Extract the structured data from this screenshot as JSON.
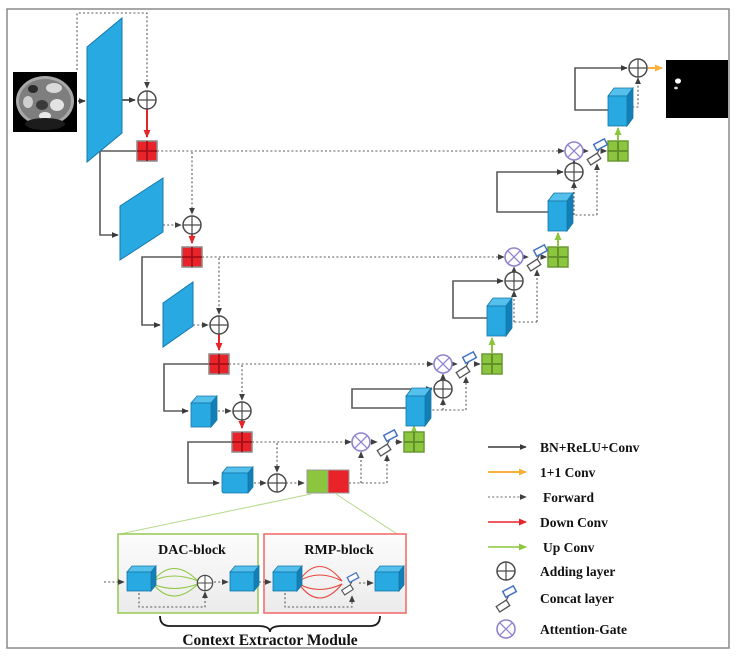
{
  "figure": {
    "labels": {
      "dac_block": "DAC-block",
      "rmp_block": "RMP-block",
      "context_extractor": "Context Extractor Module"
    }
  },
  "legend": {
    "items": [
      {
        "icon": "black-solid-arrow",
        "label": "BN+ReLU+Conv",
        "color": "#3a3a3a"
      },
      {
        "icon": "yellow-solid-arrow",
        "label": "1+1 Conv",
        "color": "#FBB03B"
      },
      {
        "icon": "gray-dotted-arrow",
        "label": "Forward",
        "color": "#666666"
      },
      {
        "icon": "red-solid-arrow",
        "label": "Down Conv",
        "color": "#E8232A"
      },
      {
        "icon": "green-solid-arrow",
        "label": "Up Conv",
        "color": "#8CC63F"
      },
      {
        "icon": "adding-layer-icon",
        "label": "Adding layer",
        "color": "#4a4a4a"
      },
      {
        "icon": "concat-layer-icon",
        "label": "Concat layer",
        "color": "#4472C4"
      },
      {
        "icon": "attention-gate-icon",
        "label": "Attention-Gate",
        "color": "#9183CF"
      }
    ]
  },
  "colors": {
    "feature_map_blue": "#29A9E1",
    "down_sample_red": "#E8232A",
    "up_sample_green": "#8CC63F",
    "final_conv_yellow": "#FBB03B",
    "attention_purple": "#9183CF",
    "dac_panel_border": "#9CCB5B",
    "rmp_panel_border": "#F17070"
  }
}
